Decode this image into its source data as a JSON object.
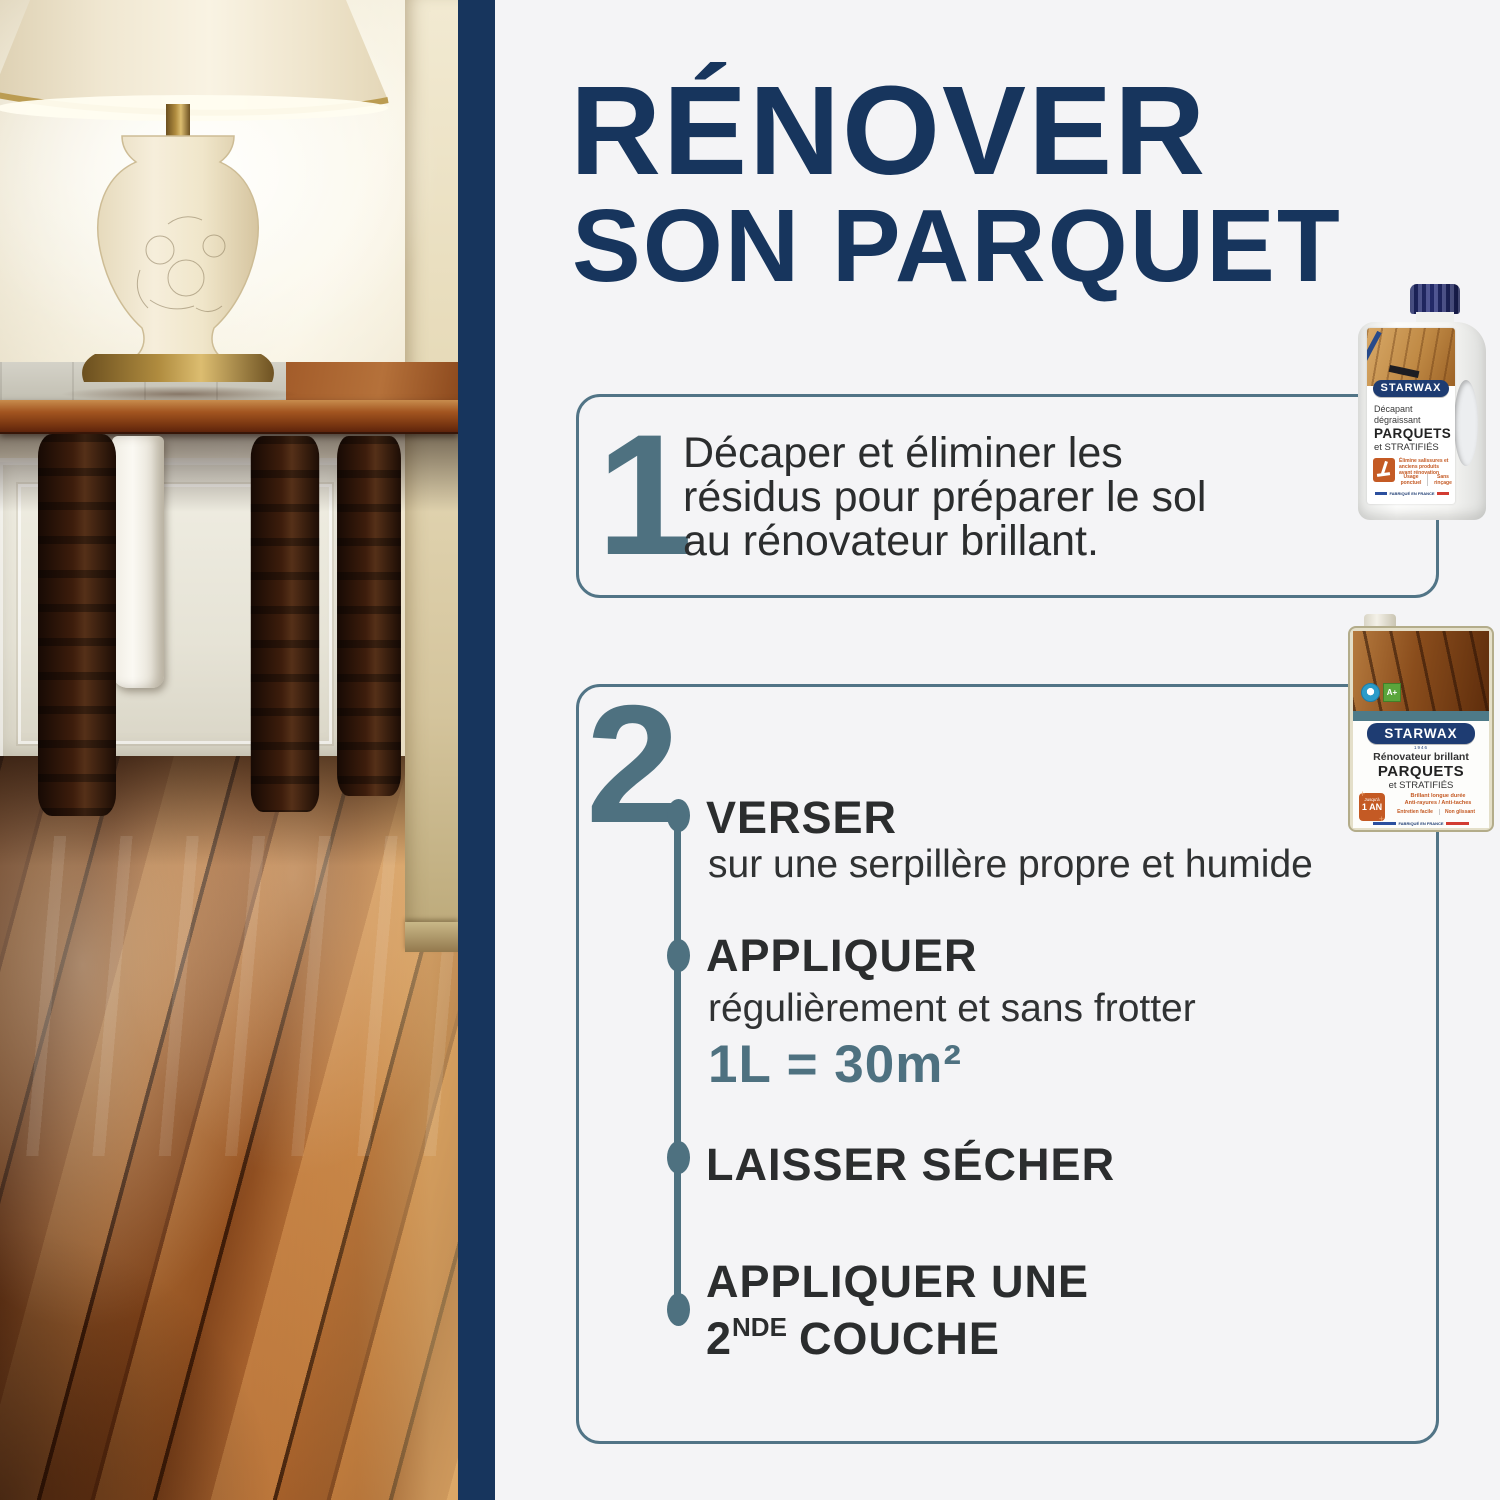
{
  "palette": {
    "navy": "#17355d",
    "slate": "#4e7180",
    "text_dark": "#2b2d2e",
    "orange": "#c45a24",
    "background": "#f4f4f6"
  },
  "title": {
    "line1": "RÉNOVER",
    "line2": "SON PARQUET"
  },
  "step1": {
    "number": "1",
    "line1": "Décaper et éliminer les",
    "line2": "résidus pour préparer le sol",
    "line3": "au rénovateur brillant."
  },
  "step2": {
    "number": "2",
    "items": [
      {
        "label": "VERSER",
        "sub": "sur une serpillère propre et humide"
      },
      {
        "label": "APPLIQUER",
        "sub": "régulièrement et sans frotter",
        "ratio": "1L = 30m²"
      },
      {
        "label": "LAISSER SÉCHER"
      },
      {
        "label_line1": "APPLIQUER UNE",
        "l2_num": "2",
        "l2_sup": "NDE",
        "l2_rest": "COUCHE"
      }
    ]
  },
  "product1": {
    "brand": "STARWAX",
    "type_line1": "Décapant",
    "type_line2": "dégraissant",
    "surface_line1": "PARQUETS",
    "surface_line2": "et STRATIFIÉS",
    "claim": "Élimine salissures et anciens produits avant rénovation",
    "feature1": "Usage ponctuel",
    "feature2": "Sans rinçage",
    "origin": "FABRIQUÉ EN FRANCE"
  },
  "product2": {
    "brand": "STARWAX",
    "year": "1946",
    "type": "Rénovateur brillant",
    "surface_line1": "PARQUETS",
    "surface_line2": "et STRATIFIÉS",
    "badge_top": "Jusqu'à",
    "badge_main": "1 AN",
    "claim1": "Brillant longue durée",
    "claim2": "Anti-rayures / Anti-taches",
    "feature1": "Entretien facile",
    "feature2": "Non glissant",
    "eco_emission": "A+",
    "origin": "FABRIQUÉ EN FRANCE"
  }
}
